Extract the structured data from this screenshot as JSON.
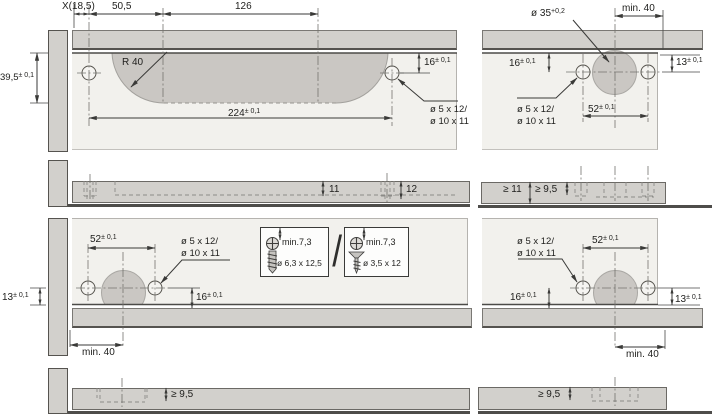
{
  "colors": {
    "panel_face": "#f2f1ed",
    "profile_gray": "#d2d0cc",
    "recess_gray": "#cac7c3",
    "line_dark": "#3e3d3b"
  },
  "views": {
    "front_left": {
      "dim_x": "X(18,5)",
      "dim_50": "50,5",
      "dim_126": "126",
      "dim_height_v": "39,5",
      "dim_height_t": "± 0,1",
      "radius_label": "R 40",
      "dim_16_v": "16",
      "dim_16_t": "± 0,1",
      "dim_224_v": "224",
      "dim_224_t": "± 0,1",
      "hole_line1": "ø 5 x 12/",
      "hole_line2": "ø 10 x 11"
    },
    "front_right": {
      "dia35_v": "ø 35",
      "dia35_t": "+0,2",
      "dim_min40": "min. 40",
      "dim_16_v": "16",
      "dim_16_t": "± 0,1",
      "dim_13_v": "13",
      "dim_13_t": "± 0,1",
      "dim_52_v": "52",
      "dim_52_t": "± 0,1",
      "hole_line1": "ø 5 x 12/",
      "hole_line2": "ø 10 x 11"
    },
    "edge_top_left": {
      "dim_11": "11",
      "dim_12": "12"
    },
    "edge_top_right": {
      "dim_ge11": "≥ 11",
      "dim_ge95": "≥ 9,5"
    },
    "bottom_left": {
      "dim_52_v": "52",
      "dim_52_t": "± 0,1",
      "hole_line1": "ø 5 x 12/",
      "hole_line2": "ø 10 x 11",
      "dim_13_v": "13",
      "dim_13_t": "± 0,1",
      "dim_16_v": "16",
      "dim_16_t": "± 0,1",
      "dim_min40": "min. 40"
    },
    "bottom_right": {
      "hole_line1": "ø 5 x 12/",
      "hole_line2": "ø 10 x 11",
      "dim_52_v": "52",
      "dim_52_t": "± 0,1",
      "dim_16_v": "16",
      "dim_16_t": "± 0,1",
      "dim_13_v": "13",
      "dim_13_t": "± 0,1",
      "dim_min40": "min. 40"
    },
    "screw_options": {
      "box1_min": "min.7,3",
      "box1_size": "ø 6,3 x 12,5",
      "separator": "/",
      "box2_min": "min.7,3",
      "box2_size": "ø 3,5 x 12"
    },
    "edge_bottom_left": {
      "dim_ge95": "≥ 9,5"
    },
    "edge_bottom_right": {
      "dim_ge95": "≥ 9,5"
    }
  }
}
